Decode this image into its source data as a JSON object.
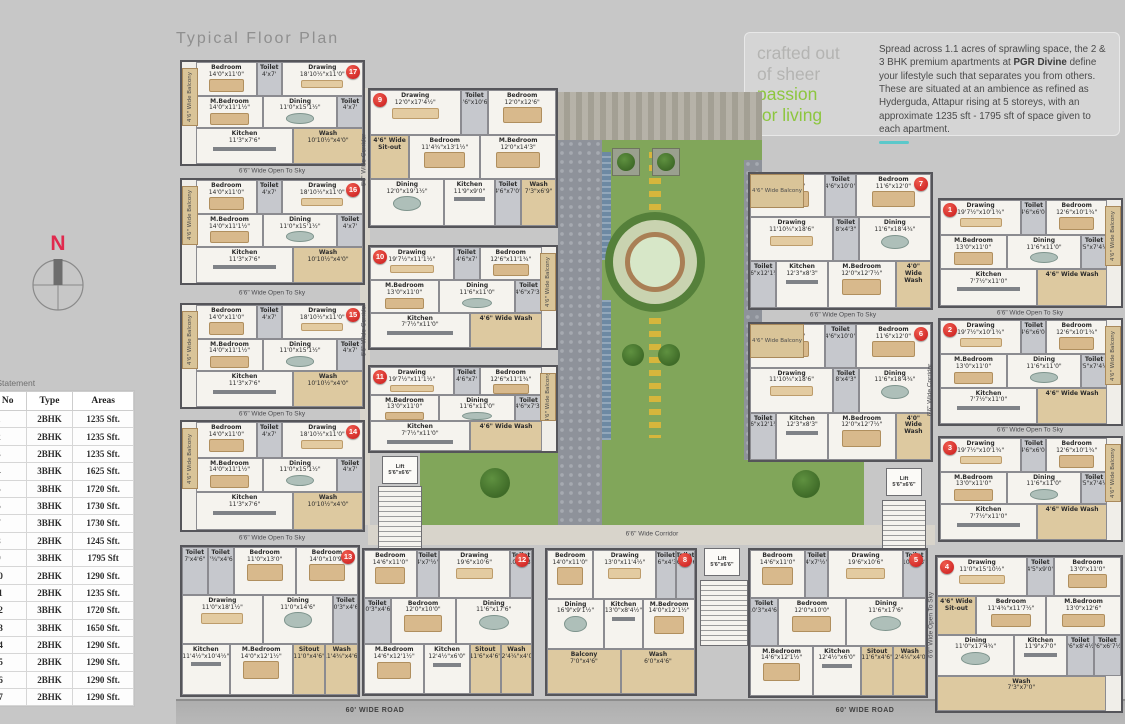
{
  "page": {
    "title": "Typical Floor Plan"
  },
  "hero": {
    "tagline": {
      "gray": [
        "crafted out",
        "of sheer"
      ],
      "green": [
        "passion",
        "for living"
      ]
    },
    "desc_pre": "Spread across 1.1 acres of sprawling space, the 2 & 3 BHK premium apartments at ",
    "brand": "PGR Divine",
    "desc_post": " define your lifestyle such that separates you from others. These are situated at an ambience as refined as Hyderguda, Attapur rising at 5 storeys, with an approximate 1235 sft - 1795 sft of space given to each apartment."
  },
  "compass": {
    "label": "N"
  },
  "area_statement": {
    "title": "Area Statement",
    "columns": [
      "Flat No",
      "Type",
      "Areas"
    ],
    "rows": [
      [
        "1",
        "2BHK",
        "1235 Sft."
      ],
      [
        "2",
        "2BHK",
        "1235 Sft."
      ],
      [
        "3",
        "2BHK",
        "1235 Sft."
      ],
      [
        "4",
        "3BHK",
        "1625 Sft."
      ],
      [
        "5",
        "3BHK",
        "1720 Sft."
      ],
      [
        "6",
        "3BHK",
        "1730 Sft."
      ],
      [
        "7",
        "3BHK",
        "1730 Sft."
      ],
      [
        "8",
        "2BHK",
        "1245 Sft."
      ],
      [
        "9",
        "3BHK",
        "1795 Sft"
      ],
      [
        "10",
        "2BHK",
        "1290 Sft."
      ],
      [
        "11",
        "2BHK",
        "1235 Sft."
      ],
      [
        "12",
        "3BHK",
        "1720 Sft."
      ],
      [
        "13",
        "3BHK",
        "1650 Sft."
      ],
      [
        "14",
        "2BHK",
        "1290 Sft."
      ],
      [
        "15",
        "2BHK",
        "1290 Sft."
      ],
      [
        "16",
        "2BHK",
        "1290 Sft."
      ],
      [
        "17",
        "2BHK",
        "1290 Sft."
      ]
    ]
  },
  "plan": {
    "roads": [
      "60' WIDE ROAD",
      "60' WIDE ROAD"
    ],
    "lift_label": "Lift 5'6\"x6'6\"",
    "labels": [
      {
        "t": "6'6\" Wide Open To Sky",
        "x": 272,
        "y": 171
      },
      {
        "t": "6'6\" Wide Open To Sky",
        "x": 272,
        "y": 293
      },
      {
        "t": "6'6\" Wide Open To Sky",
        "x": 272,
        "y": 414
      },
      {
        "t": "6'6\" Wide Open To Sky",
        "x": 272,
        "y": 538
      },
      {
        "t": "6'6\" Wide Corridor",
        "x": 364,
        "y": 160,
        "v": true
      },
      {
        "t": "6'6\" Wide Corridor",
        "x": 364,
        "y": 330,
        "v": true
      },
      {
        "t": "6'6\" Wide Corridor",
        "x": 652,
        "y": 534
      },
      {
        "t": "6'6\" Wide Open To Sky",
        "x": 843,
        "y": 315
      },
      {
        "t": "6'6\" Wide Open To Sky",
        "x": 1030,
        "y": 313
      },
      {
        "t": "6'6\" Wide Open To Sky",
        "x": 1030,
        "y": 430
      },
      {
        "t": "6'6\" Wide Corridor",
        "x": 930,
        "y": 390,
        "v": true
      },
      {
        "t": "6'6\" Wide Open To Sky",
        "x": 931,
        "y": 625,
        "v": true
      }
    ],
    "room_types": {
      "A": [
        {
          "n": "Bedroom",
          "d": "14'0\"x11'0\""
        },
        {
          "n": "Toilet",
          "d": "4'x7'"
        },
        {
          "n": "Drawing",
          "d": "18'10½\"x11'0\""
        },
        {
          "n": "M.Bedroom",
          "d": "14'0\"x11'1½\""
        },
        {
          "n": "Dining",
          "d": "11'0\"x15'1½\""
        },
        {
          "n": "Toilet",
          "d": "4'x7'"
        },
        {
          "n": "Kitchen",
          "d": "11'3\"x7'6\""
        },
        {
          "n": "Wash",
          "d": "10'10½\"x4'0\""
        }
      ],
      "T9": [
        {
          "n": "Drawing",
          "d": "12'0\"x17'4½\""
        },
        {
          "n": "Toilet",
          "d": "4'6\"x10'6\""
        },
        {
          "n": "Bedroom",
          "d": "12'0\"x12'6\""
        },
        {
          "n": "4'6\" Wide Sit-out"
        },
        {
          "n": "Bedroom",
          "d": "11'4¾\"x13'1½\""
        },
        {
          "n": "M.Bedroom",
          "d": "12'0\"x14'3\""
        },
        {
          "n": "Dining",
          "d": "12'0\"x19'1½\""
        },
        {
          "n": "Kitchen",
          "d": "11'9\"x9'0\""
        },
        {
          "n": "Toilet",
          "d": "4'6\"x7'0\""
        },
        {
          "n": "Wash",
          "d": "7'3\"x6'9\""
        }
      ],
      "B": [
        {
          "n": "Drawing",
          "d": "19'7½\"x11'1½\""
        },
        {
          "n": "Toilet",
          "d": "4'6\"x7'"
        },
        {
          "n": "Bedroom",
          "d": "12'6\"x11'1¾\""
        },
        {
          "n": "M.Bedroom",
          "d": "13'0\"x11'0\""
        },
        {
          "n": "Dining",
          "d": "11'6\"x11'0\""
        },
        {
          "n": "Toilet",
          "d": "4'6\"x7'3\""
        },
        {
          "n": "Kitchen",
          "d": "7'7½\"x11'0\""
        },
        {
          "n": "4'6\" Wide Wash"
        }
      ],
      "B2": [
        {
          "n": "Drawing",
          "d": "19'7½\"x10'1¾\""
        },
        {
          "n": "Toilet",
          "d": "4'6\"x6'0\""
        },
        {
          "n": "Bedroom",
          "d": "12'6\"x10'1¾\""
        },
        {
          "n": "M.Bedroom",
          "d": "13'0\"x11'0\""
        },
        {
          "n": "Dining",
          "d": "11'6\"x11'0\""
        },
        {
          "n": "Toilet",
          "d": "4'5\"x7'4½\""
        },
        {
          "n": "Kitchen",
          "d": "7'7½\"x11'0\""
        },
        {
          "n": "4'6\" Wide Wash"
        }
      ],
      "C": [
        {
          "n": "Bedroom",
          "d": "12'0\"x10'0\""
        },
        {
          "n": "Toilet",
          "d": "4'6\"x10'0\""
        },
        {
          "n": "Bedroom",
          "d": "11'6\"x12'0\""
        },
        {
          "n": "Drawing",
          "d": "11'10¾\"x18'6\""
        },
        {
          "n": "Toilet",
          "d": "8'x4'3\""
        },
        {
          "n": "Dining",
          "d": "11'6\"x18'4¾\""
        },
        {
          "n": "Toilet",
          "d": "4'6\"x12'1¾\""
        },
        {
          "n": "Kitchen",
          "d": "12'3\"x8'3\""
        },
        {
          "n": "M.Bedroom",
          "d": "12'0\"x12'7½\""
        },
        {
          "n": "4'0\" Wide Wash"
        }
      ],
      "T13": [
        {
          "n": "Toilet",
          "d": "7'x4'6\""
        },
        {
          "n": "Toilet",
          "d": "7'¾\"x4'6\""
        },
        {
          "n": "Bedroom",
          "d": "11'0\"x13'0\""
        },
        {
          "n": "Bedroom",
          "d": "14'0\"x10'9\""
        },
        {
          "n": "Drawing",
          "d": "11'0\"x18'1½\""
        },
        {
          "n": "Dining",
          "d": "11'0\"x14'6\""
        },
        {
          "n": "Toilet",
          "d": "10'3\"x4'6\""
        },
        {
          "n": "Kitchen",
          "d": "11'4½\"x10'4½\""
        },
        {
          "n": "M.Bedroom",
          "d": "14'0\"x12'1½\""
        },
        {
          "n": "Sitout",
          "d": "11'0\"x4'6\""
        },
        {
          "n": "Wash",
          "d": "11'4¾\"x4'6\""
        }
      ],
      "D": [
        {
          "n": "Bedroom",
          "d": "14'6\"x11'0\""
        },
        {
          "n": "Toilet",
          "d": "4'x7'½\""
        },
        {
          "n": "Drawing",
          "d": "19'6\"x10'6\""
        },
        {
          "n": "Toilet",
          "d": "10'x4'3\""
        },
        {
          "n": "Toilet",
          "d": "10'3\"x4'6\""
        },
        {
          "n": "Bedroom",
          "d": "12'0\"x10'0\""
        },
        {
          "n": "Dining",
          "d": "11'6\"x17'6\""
        },
        {
          "n": "M.Bedroom",
          "d": "14'6\"x12'1½\""
        },
        {
          "n": "Kitchen",
          "d": "12'4½\"x6'0\""
        },
        {
          "n": "Sitout",
          "d": "11'6\"x4'6\""
        },
        {
          "n": "Wash",
          "d": "12'4¼\"x4'0\""
        }
      ],
      "T8": [
        {
          "n": "Bedroom",
          "d": "14'0\"x11'0\""
        },
        {
          "n": "Drawing",
          "d": "13'0\"x11'4½\""
        },
        {
          "n": "Toilet",
          "d": "9'6\"x4'3\""
        },
        {
          "n": "Toilet",
          "d": "9'6\"x4'6\""
        },
        {
          "n": "Dining",
          "d": "16'9\"x9'1½\""
        },
        {
          "n": "Kitchen",
          "d": "13'0\"x8'4½\""
        },
        {
          "n": "M.Bedroom",
          "d": "14'0\"x12'1½\""
        },
        {
          "n": "Balcony",
          "d": "7'0\"x4'6\""
        },
        {
          "n": "Wash",
          "d": "6'0\"x4'6\""
        }
      ],
      "T4": [
        {
          "n": "Drawing",
          "d": "11'0\"x15'10½\""
        },
        {
          "n": "Toilet",
          "d": "4'5\"x9'0\""
        },
        {
          "n": "Bedroom",
          "d": "13'0\"x11'0\""
        },
        {
          "n": "4'6\" Wide Sit-out"
        },
        {
          "n": "Bedroom",
          "d": "11'4¾\"x11'7½\""
        },
        {
          "n": "M.Bedroom",
          "d": "13'0\"x12'6\""
        },
        {
          "n": "Dining",
          "d": "11'0\"x17'4¾\""
        },
        {
          "n": "Kitchen",
          "d": "11'9\"x7'0\""
        },
        {
          "n": "Toilet",
          "d": "4'6\"x8'4½\""
        },
        {
          "n": "Toilet",
          "d": "4'6\"x6'7½\""
        },
        {
          "n": "Wash",
          "d": "7'3\"x7'0\""
        }
      ]
    },
    "balcony_labels": {
      "side": "4'6\" Wide Balcony"
    },
    "units": [
      {
        "id": "17",
        "rt": "A",
        "x": 180,
        "y": 60,
        "w": 185,
        "h": 106,
        "badge": "tr",
        "balcony": {
          "side": "left",
          "label": "4'6\" Wide Balcony"
        }
      },
      {
        "id": "16",
        "rt": "A",
        "x": 180,
        "y": 178,
        "w": 185,
        "h": 107,
        "badge": "tr",
        "balcony": {
          "side": "left",
          "label": "4'6\" Wide Balcony"
        }
      },
      {
        "id": "15",
        "rt": "A",
        "x": 180,
        "y": 303,
        "w": 185,
        "h": 106,
        "badge": "tr",
        "balcony": {
          "side": "left",
          "label": "4'6\" Wide Balcony"
        }
      },
      {
        "id": "14",
        "rt": "A",
        "x": 180,
        "y": 420,
        "w": 185,
        "h": 112,
        "badge": "tr",
        "balcony": {
          "side": "left",
          "label": "4'6\" Wide Balcony"
        }
      },
      {
        "id": "9",
        "rt": "T9",
        "x": 368,
        "y": 88,
        "w": 190,
        "h": 140,
        "badge": "tl",
        "balcony": null
      },
      {
        "id": "10",
        "rt": "B",
        "x": 368,
        "y": 245,
        "w": 190,
        "h": 105,
        "badge": "tl",
        "balcony": {
          "side": "right",
          "label": "4'6\" Wide Balcony"
        }
      },
      {
        "id": "11",
        "rt": "B",
        "x": 368,
        "y": 365,
        "w": 190,
        "h": 88,
        "badge": "tl",
        "balcony": {
          "side": "right",
          "label": "4'6\" Wide Balcony"
        }
      },
      {
        "id": "7",
        "rt": "C",
        "x": 748,
        "y": 172,
        "w": 185,
        "h": 138,
        "badge": "tr",
        "balcony": {
          "side": "tl",
          "label": "4'6\" Wide Balcony"
        }
      },
      {
        "id": "6",
        "rt": "C",
        "x": 748,
        "y": 322,
        "w": 185,
        "h": 140,
        "badge": "tr",
        "balcony": {
          "side": "tl",
          "label": "4'6\" Wide Balcony"
        }
      },
      {
        "id": "1",
        "rt": "B2",
        "x": 938,
        "y": 198,
        "w": 185,
        "h": 110,
        "badge": "tl",
        "balcony": {
          "side": "right",
          "label": "4'6\" Wide Balcony"
        }
      },
      {
        "id": "2",
        "rt": "B2",
        "x": 938,
        "y": 318,
        "w": 185,
        "h": 108,
        "badge": "tl",
        "balcony": {
          "side": "right",
          "label": "4'6\" Wide Balcony"
        }
      },
      {
        "id": "3",
        "rt": "B2",
        "x": 938,
        "y": 436,
        "w": 185,
        "h": 106,
        "badge": "tl",
        "balcony": {
          "side": "right",
          "label": "4'6\" Wide Balcony"
        }
      },
      {
        "id": "13",
        "rt": "T13",
        "x": 180,
        "y": 545,
        "w": 180,
        "h": 152,
        "badge": "tr",
        "balcony": null
      },
      {
        "id": "12",
        "rt": "D",
        "x": 362,
        "y": 548,
        "w": 172,
        "h": 148,
        "badge": "tr",
        "balcony": null
      },
      {
        "id": "8",
        "rt": "T8",
        "x": 545,
        "y": 548,
        "w": 152,
        "h": 148,
        "badge": "tr",
        "balcony": null
      },
      {
        "id": "5",
        "rt": "D",
        "x": 748,
        "y": 548,
        "w": 180,
        "h": 150,
        "badge": "tr",
        "balcony": null
      },
      {
        "id": "4",
        "rt": "T4",
        "x": 935,
        "y": 555,
        "w": 188,
        "h": 158,
        "badge": "tl",
        "balcony": null
      }
    ]
  },
  "colors": {
    "accent_green": "#8dc63f",
    "badge_red": "#c8191b",
    "lawn_green": "#81a65a",
    "teal_link": "#5bc8ca",
    "compass_north": "#e02a4e"
  }
}
